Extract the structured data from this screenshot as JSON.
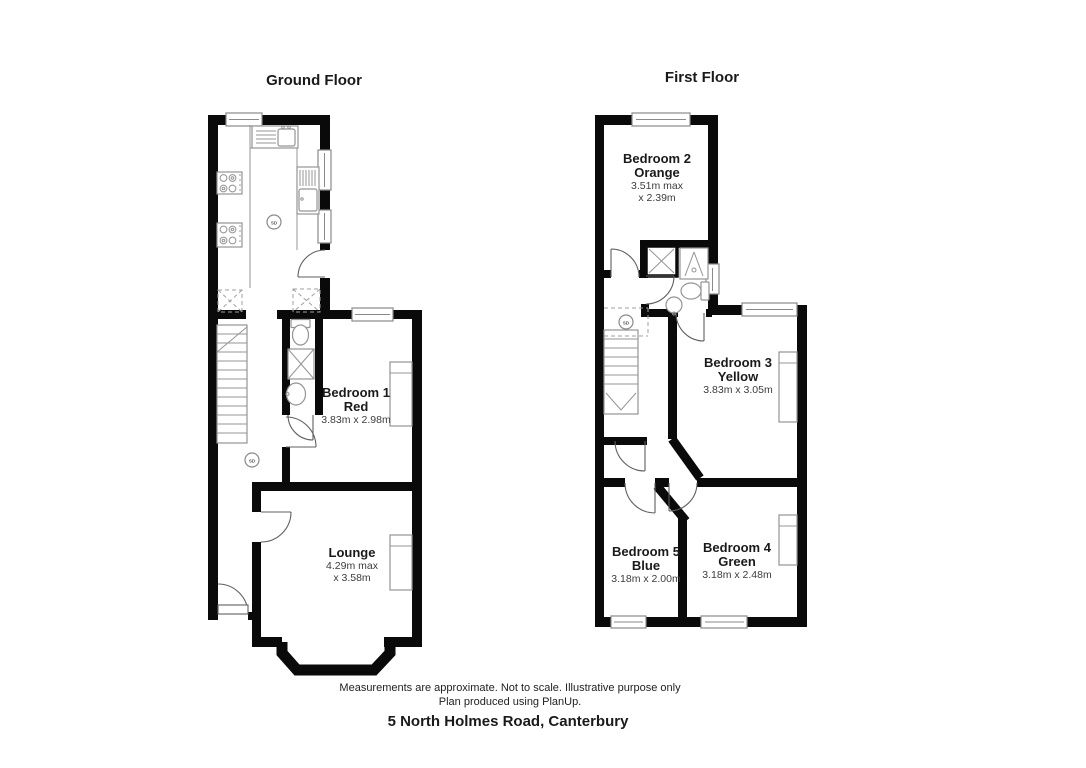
{
  "ground_floor": {
    "title": "Ground Floor",
    "sd_label": "SD",
    "rooms": [
      {
        "id": "bedroom-1",
        "name": "Bedroom 1",
        "color": "Red",
        "dim1": "3.83m x 2.98m"
      },
      {
        "id": "lounge",
        "name": "Lounge",
        "dim1": "4.29m max",
        "dim2": "x 3.58m"
      }
    ]
  },
  "first_floor": {
    "title": "First Floor",
    "sd_label": "SD",
    "rooms": [
      {
        "id": "bedroom-2",
        "name": "Bedroom 2",
        "color": "Orange",
        "dim1": "3.51m max",
        "dim2": "x 2.39m"
      },
      {
        "id": "bedroom-3",
        "name": "Bedroom 3",
        "color": "Yellow",
        "dim1": "3.83m x 3.05m"
      },
      {
        "id": "bedroom-5",
        "name": "Bedroom 5",
        "color": "Blue",
        "dim1": "3.18m x 2.00m"
      },
      {
        "id": "bedroom-4",
        "name": "Bedroom 4",
        "color": "Green",
        "dim1": "3.18m x 2.48m"
      }
    ]
  },
  "footer": {
    "disclaimer_line1": "Measurements are approximate. Not to scale. Illustrative purpose only",
    "disclaimer_line2": "Plan produced using PlanUp.",
    "address": "5 North Holmes Road, Canterbury"
  },
  "colors": {
    "wall": "#0a0a0a",
    "fixture_gray": "#949494",
    "text": "#1a1a1a"
  }
}
